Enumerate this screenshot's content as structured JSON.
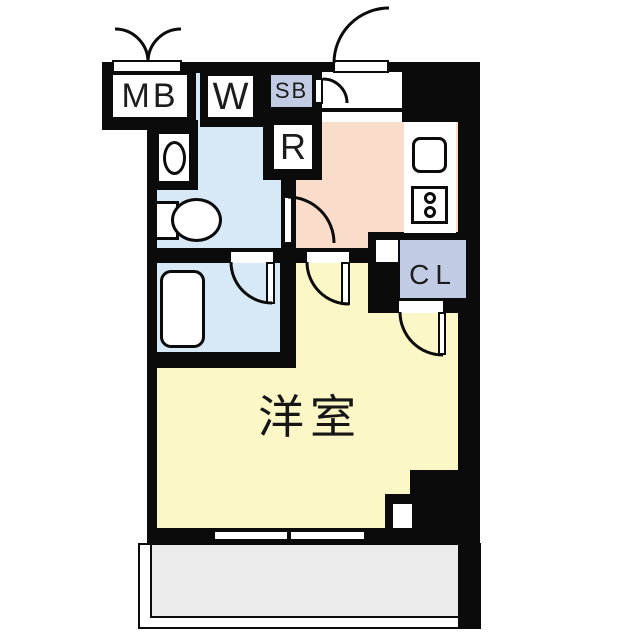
{
  "floorplan": {
    "labels": {
      "meter_box": "MB",
      "washing_machine": "W",
      "shoe_box": "SB",
      "refrigerator": "R",
      "closet": "CL",
      "western_room": "洋室"
    },
    "colors": {
      "wall": "#0b0b0b",
      "wet_area": "#d7e9f6",
      "kitchen": "#f9dcc9",
      "room": "#fbf7c6",
      "storage": "#c1cbe3",
      "balcony": "#ebebeb",
      "line": "#111111"
    }
  }
}
